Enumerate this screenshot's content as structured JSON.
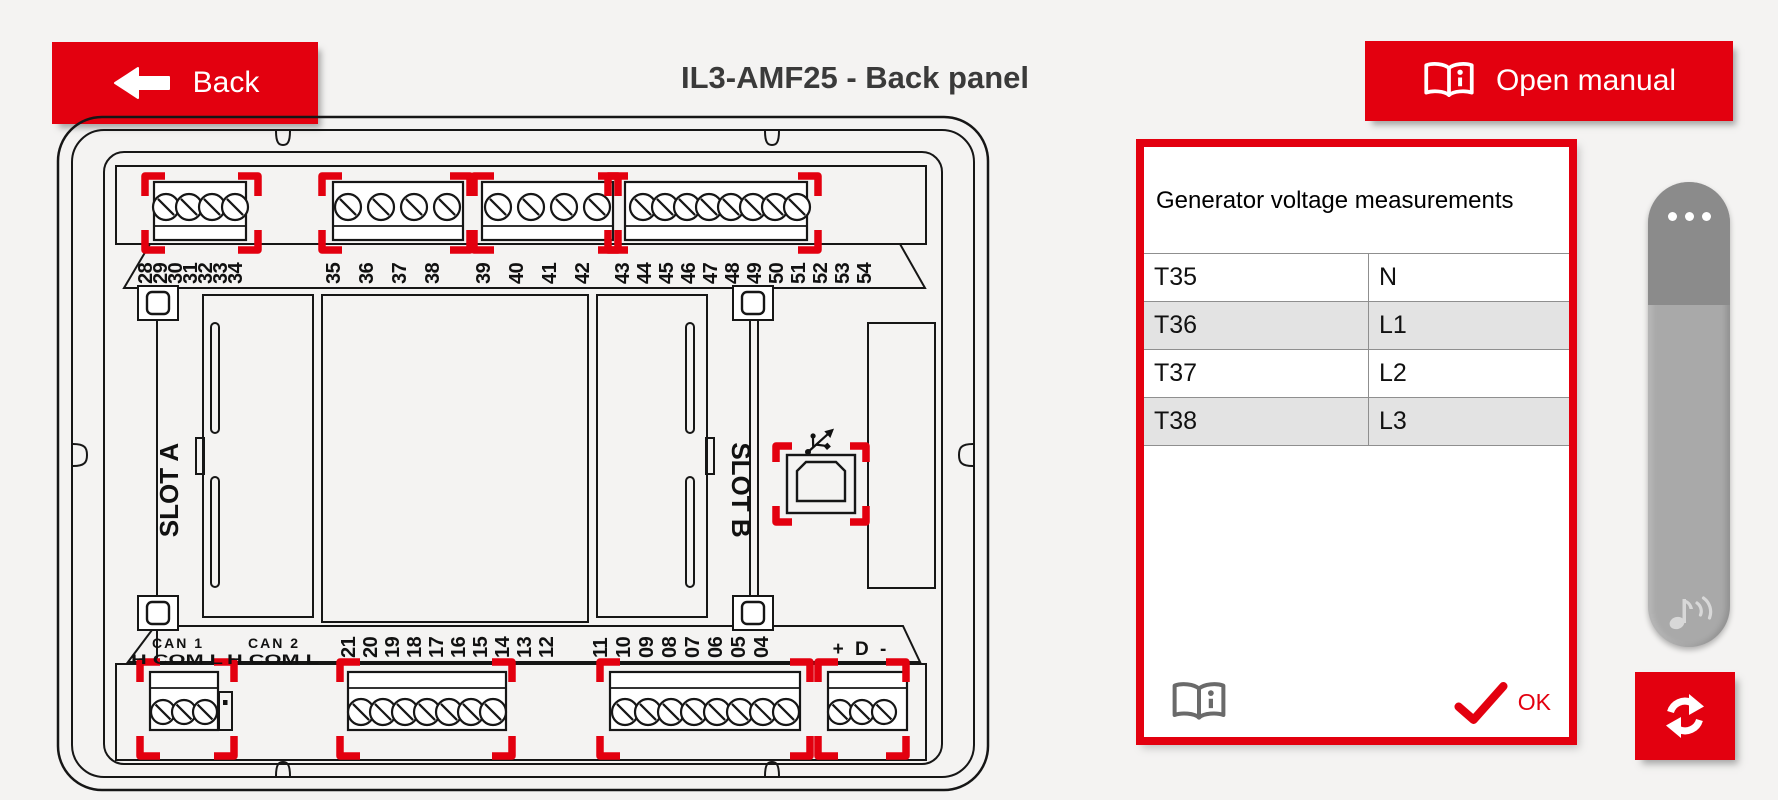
{
  "header": {
    "back_label": "Back",
    "title": "IL3-AMF25 - Back panel",
    "open_manual_label": "Open manual"
  },
  "diagram": {
    "top_terminals": [
      "28",
      "29",
      "30",
      "31",
      "32",
      "33",
      "34",
      "35",
      "36",
      "37",
      "38",
      "39",
      "40",
      "41",
      "42",
      "43",
      "44",
      "45",
      "46",
      "47",
      "48",
      "49",
      "50",
      "51",
      "52",
      "53",
      "54"
    ],
    "bottom_terminals": [
      "21",
      "20",
      "19",
      "18",
      "17",
      "16",
      "15",
      "14",
      "13",
      "12",
      "11",
      "10",
      "09",
      "08",
      "07",
      "06",
      "05",
      "04"
    ],
    "can1_label": "CAN 1",
    "can2_label": "CAN 2",
    "can_pins_label": "H COM L",
    "slot_a_label": "SLOT A",
    "slot_b_label": "SLOT B",
    "d_bus_label": "+ D -"
  },
  "info_panel": {
    "title": "Generator voltage measurements",
    "rows": [
      {
        "terminal": "T35",
        "phase": "N"
      },
      {
        "terminal": "T36",
        "phase": "L1"
      },
      {
        "terminal": "T37",
        "phase": "L2"
      },
      {
        "terminal": "T38",
        "phase": "L3"
      }
    ],
    "ok_label": "OK"
  },
  "colors": {
    "accent_red": "#e3000f",
    "row_alt": "#e3e3e3",
    "scrollbar_cap": "#8b8b8b",
    "scrollbar_body": "#a9a9a9"
  }
}
